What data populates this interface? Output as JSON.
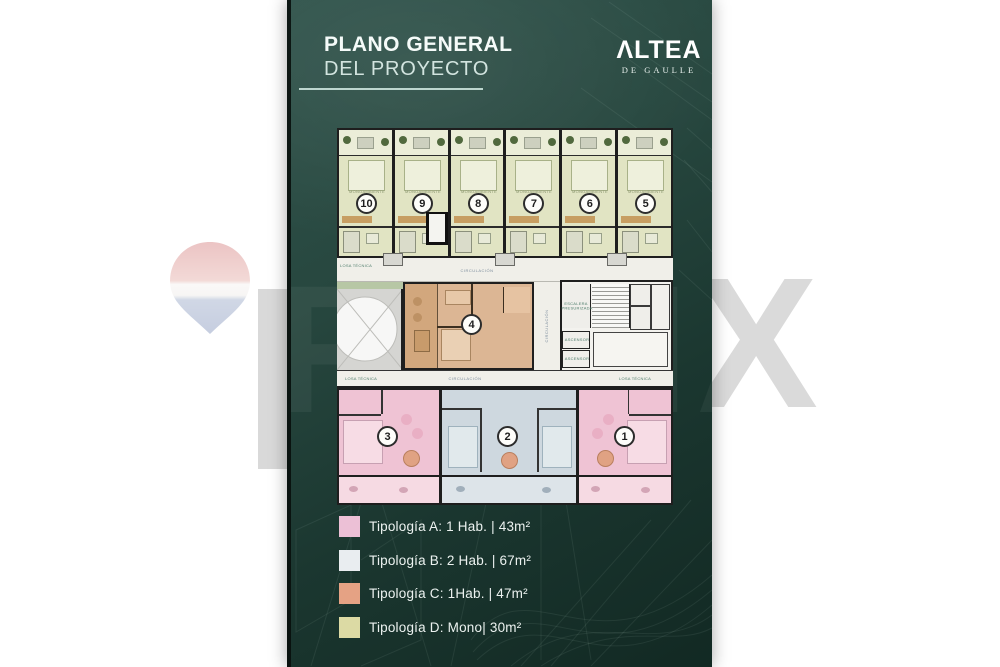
{
  "header": {
    "title_line1": "PLANO GENERAL",
    "title_line2": "DEL PROYECTO"
  },
  "logo": {
    "name": "ΛLTEA",
    "subtitle": "DE GAULLE"
  },
  "plan": {
    "labels": {
      "circulation": "CIRCULACIÓN",
      "technical_slab": "LOSA TÉCNICA",
      "stairs": "ESCALERA PRESURIZADA",
      "elevator": "ASCENSOR",
      "mono_room": "MONOAMBIENTE"
    },
    "top_units": [
      {
        "number": "10",
        "typology": "D"
      },
      {
        "number": "9",
        "typology": "D"
      },
      {
        "number": "8",
        "typology": "D"
      },
      {
        "number": "7",
        "typology": "D"
      },
      {
        "number": "6",
        "typology": "D"
      },
      {
        "number": "5",
        "typology": "D"
      }
    ],
    "middle_unit": {
      "number": "4",
      "typology": "C"
    },
    "bottom_units": [
      {
        "number": "3",
        "typology": "A"
      },
      {
        "number": "2",
        "typology": "B"
      },
      {
        "number": "1",
        "typology": "A"
      }
    ]
  },
  "legend": {
    "items": [
      {
        "label": "Tipología A: 1 Hab. | 43m²",
        "color": "#ecc0d6"
      },
      {
        "label": "Tipología B: 2 Hab. | 67m²",
        "color": "#e9edf0"
      },
      {
        "label": "Tipología C: 1Hab. | 47m²",
        "color": "#e5a284"
      },
      {
        "label": "Tipología D: Mono| 30m²",
        "color": "#dcdaa4"
      }
    ]
  },
  "colors": {
    "panel_top": "#31544c",
    "panel_bottom": "#122923",
    "typology_a_fill": "#efc3d4",
    "typology_b_fill": "#ced8df",
    "typology_c_fill": "#dcb694",
    "typology_d_fill": "#e1e4c3"
  },
  "watermark": {
    "letters_faint": "REMA",
    "letter_right": "X"
  }
}
